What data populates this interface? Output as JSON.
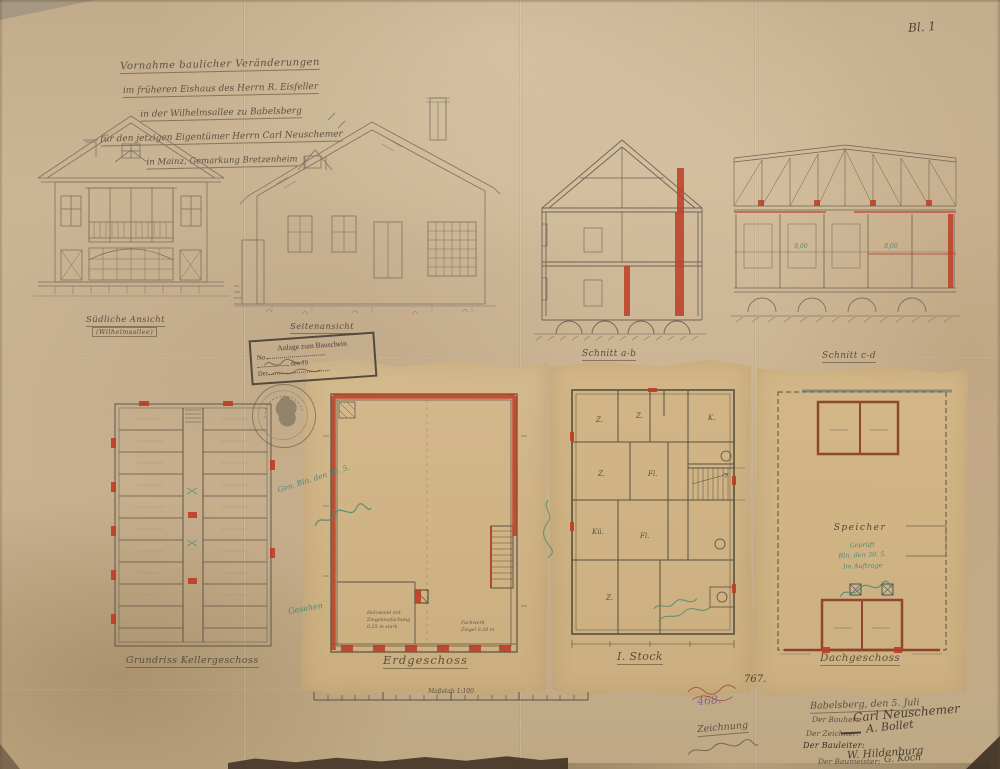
{
  "colors": {
    "paper": "#c9b392",
    "glued_sheet": "#cfb287",
    "pencil": "#7b6e5f",
    "ink": "#564d3f",
    "red_accent": "#bc3e26",
    "wall_brown": "#8a3b26",
    "approval_green": "#4e8a72",
    "purple_pencil": "#8064a0",
    "stamp_ink": "#46413a"
  },
  "header": {
    "sheet_number": "Bl. 1",
    "title_lines": [
      "Vornahme baulicher Veränderungen",
      "im früheren Eishaus des Herrn R. Eisfeller",
      "in der Wilhelmsallee zu Babelsberg",
      "für den jetzigen Eigentümer Herrn Carl Neuschemer",
      "in Mainz, Gemarkung Bretzenheim"
    ]
  },
  "drawings": {
    "elevation_front": {
      "label": "Südliche Ansicht",
      "sublabel": "(Wilhelmsallee)"
    },
    "elevation_side": {
      "label": "Seitenansicht"
    },
    "section_ab": {
      "label": "Schnitt a-b"
    },
    "section_cd": {
      "label": "Schnitt c-d",
      "dims": [
        "8,00",
        "8,00"
      ]
    }
  },
  "plans": {
    "keller": {
      "label": "Grundriss Kellergeschoss"
    },
    "erdgeschoss": {
      "label": "Erdgeschoss",
      "note_left": [
        "Holzwand mit",
        "Ziegelausfachung",
        "0,25 m stark"
      ],
      "note_right": [
        "Fachwerk",
        "Ziegel 0,38 m"
      ]
    },
    "stock": {
      "label": "I. Stock",
      "rooms": [
        "Z.",
        "Z.",
        "K.",
        "Z.",
        "Fl.",
        "Kü.",
        "Fl.",
        "Z."
      ]
    },
    "dach": {
      "label": "Dachgeschoss",
      "rooms": [
        "Speicher"
      ]
    }
  },
  "stamp": {
    "lines": [
      "Anlage zum Bauschein",
      "No.",
      ", den  19",
      "Der"
    ]
  },
  "scale": {
    "label": "Maßstab 1:100"
  },
  "signature_block": {
    "date_line": "Babelsberg, den 5. Juli",
    "rows": [
      {
        "label": "Der Bauherr:",
        "signature": "Carl Neuschemer"
      },
      {
        "label": "Der Zeichner:",
        "signature": "A. Bollet"
      },
      {
        "label": "Der Bauleiter:",
        "signature": "W. Hildenburg"
      },
      {
        "label": "Der Baumeister:",
        "signature": "G. Koch"
      }
    ]
  },
  "annotations": {
    "gen_note": "Gen. Bln. den 30. 5.",
    "gesehen": "Gesehen",
    "gepr_line1": "Geprüft",
    "gepr_line2": "Bln. den 30. 5.",
    "gepr_line3": "Im Auftrage",
    "number_dark": "767.",
    "number_purple": "468.",
    "left_cursive": "Zeichnung"
  }
}
